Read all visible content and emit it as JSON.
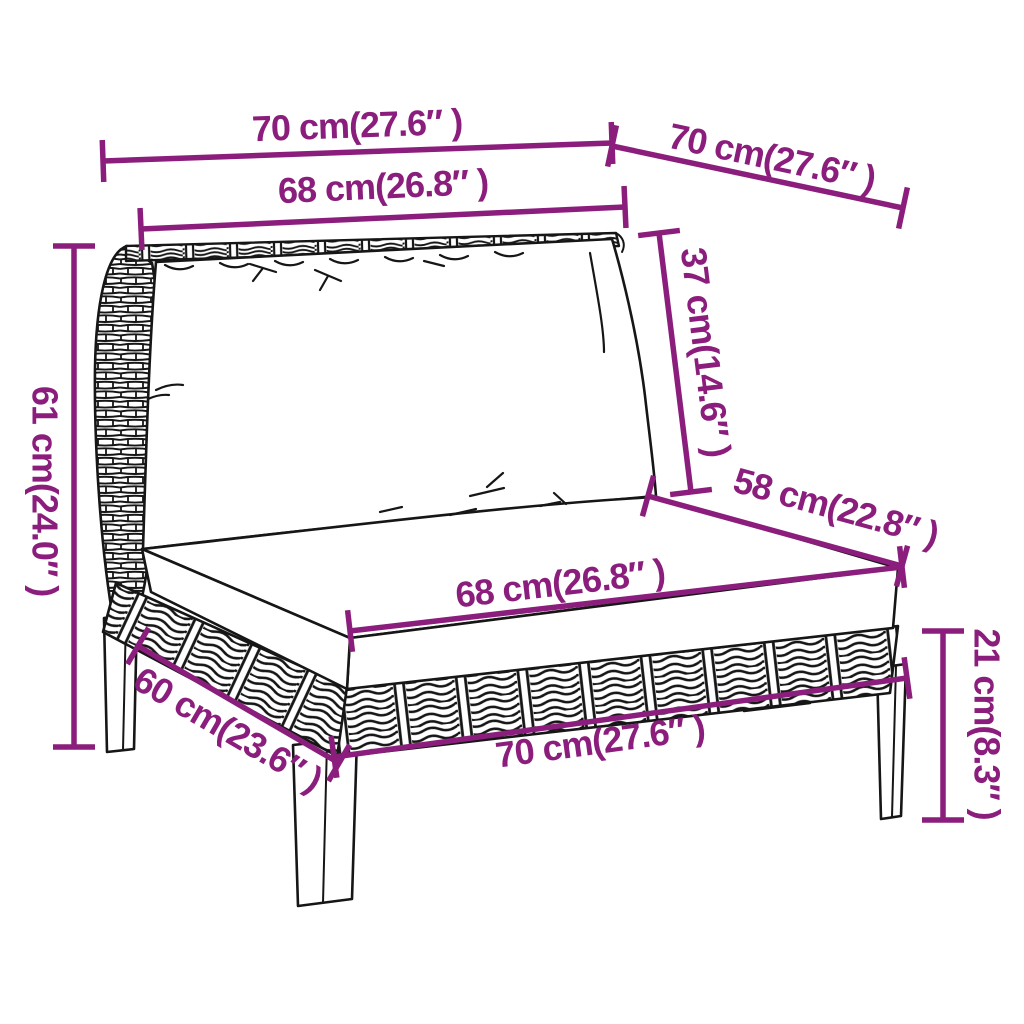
{
  "diagram": {
    "type": "product-dimension-diagram",
    "subject": "half-round poly rattan garden sofa middle section with back and seat cushions",
    "style": "black line art with magenta dimension annotations on white background"
  },
  "colors": {
    "dimension": "#8B1E7C",
    "line": "#161616",
    "background": "#FFFFFF",
    "cushion": "#FFFFFF"
  },
  "dimensions": [
    {
      "id": "top-width",
      "label": "70 cm(27.6″ )",
      "cm": 70,
      "inch": 27.6,
      "x1": 103,
      "y1": 161,
      "x2": 612,
      "y2": 143,
      "lx": 357,
      "ly": 125
    },
    {
      "id": "top-depth",
      "label": "70 cm(27.6″ )",
      "cm": 70,
      "inch": 27.6,
      "x1": 612,
      "y1": 146,
      "x2": 903,
      "y2": 208,
      "lx": 772,
      "ly": 157
    },
    {
      "id": "backrest-width",
      "label": "68 cm(26.8″ )",
      "cm": 68,
      "inch": 26.8,
      "x1": 141,
      "y1": 229,
      "x2": 625,
      "y2": 207,
      "lx": 383,
      "ly": 186
    },
    {
      "id": "back-cushion-height",
      "label": "37 cm(14.6″ )",
      "cm": 37,
      "inch": 14.6,
      "x1": 659,
      "y1": 233,
      "x2": 691,
      "y2": 492,
      "lx": 706,
      "ly": 352
    },
    {
      "id": "seat-depth",
      "label": "58 cm(22.8″ )",
      "cm": 58,
      "inch": 22.8,
      "x1": 648,
      "y1": 496,
      "x2": 902,
      "y2": 566,
      "lx": 836,
      "ly": 507
    },
    {
      "id": "total-height",
      "label": "61 cm(24.0″ )",
      "cm": 61,
      "inch": 24.0,
      "x1": 74,
      "y1": 246,
      "x2": 74,
      "y2": 747,
      "lx": 45,
      "ly": 491
    },
    {
      "id": "seat-cushion-width",
      "label": "68 cm(26.8″ )",
      "cm": 68,
      "inch": 26.8,
      "x1": 350,
      "y1": 631,
      "x2": 902,
      "y2": 567,
      "lx": 560,
      "ly": 583
    },
    {
      "id": "leg-height",
      "label": "21 cm(8.3″ )",
      "cm": 21,
      "inch": 8.3,
      "x1": 943,
      "y1": 631,
      "x2": 943,
      "y2": 820,
      "lx": 987,
      "ly": 724
    },
    {
      "id": "base-depth",
      "label": "60 cm(23.6″ )",
      "cm": 60,
      "inch": 23.6,
      "x1": 138,
      "y1": 646,
      "x2": 339,
      "y2": 763,
      "lx": 228,
      "ly": 729
    },
    {
      "id": "base-width",
      "label": "70 cm(27.6″ )",
      "cm": 70,
      "inch": 27.6,
      "x1": 334,
      "y1": 757,
      "x2": 907,
      "y2": 678,
      "lx": 600,
      "ly": 741
    }
  ]
}
